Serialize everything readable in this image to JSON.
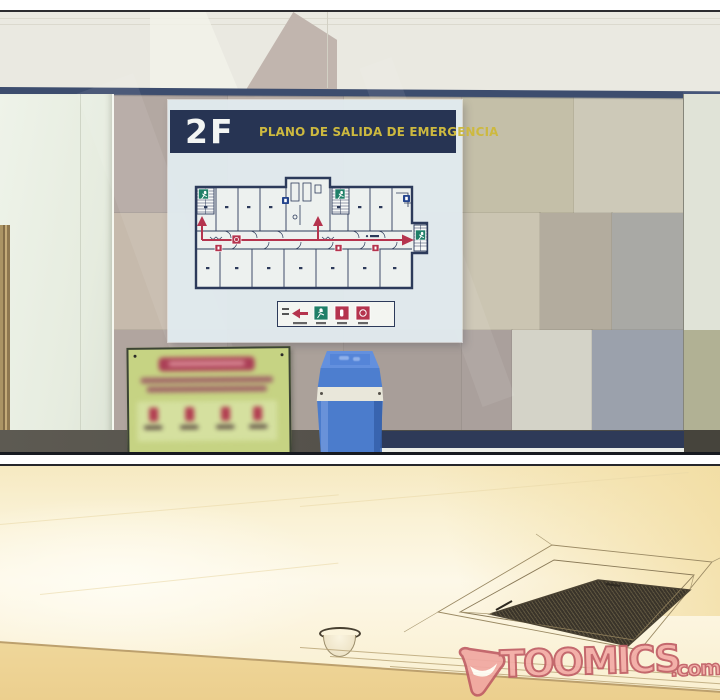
{
  "comic": {
    "source_brand": "TOOMICS",
    "watermark": {
      "brand": "TOOMICS",
      "suffix": ".com",
      "fill_color": "#f3aca6",
      "outline_color": "#c05f66"
    }
  },
  "panel1": {
    "description": "hallway wall with emergency evacuation plan board, blurred green notice sign and blue trash can",
    "molding_color": "#3d4d6e",
    "board": {
      "floor_label": "2F",
      "title": "PLANO DE SALIDA DE EMERGENCIA",
      "header_bg": "#273453",
      "title_color": "#cdb93f",
      "floor_label_color": "#f3f5f3",
      "plan": {
        "outline_color": "#2c3a5a",
        "route_color": "#b5344e",
        "exit_sign_color": "#1f7f68",
        "hydrant_icon_color": "#24458e",
        "legend_icons": [
          "route-arrow-icon",
          "exit-man-icon",
          "extinguisher-icon",
          "hydrant-icon"
        ]
      }
    },
    "green_sign": {
      "bg": "#c6d383",
      "accent": "#ab3f56",
      "text_blurred": true
    },
    "trash_can_color": "#4b7ccc"
  },
  "panel2": {
    "description": "ceiling with cassette air-conditioner vent and dome fixture",
    "ceiling_color": "#faf2d6",
    "cornice_color": "#f1dda4"
  }
}
